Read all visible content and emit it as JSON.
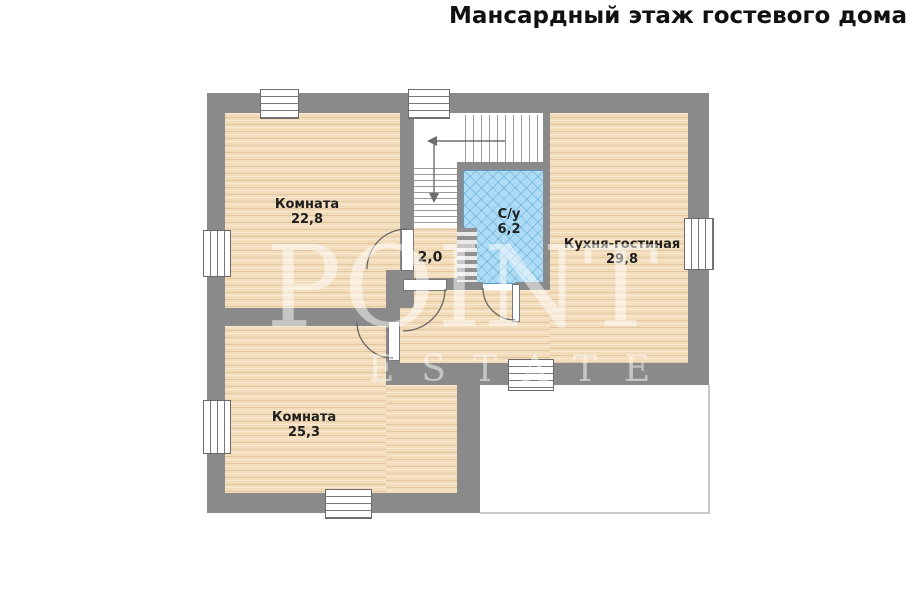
{
  "title": "Мансардный этаж гостевого дома",
  "watermark": {
    "line1": "POINT",
    "line2": "ESTATE"
  },
  "rooms": {
    "bedroom_top": {
      "name": "Комната",
      "area": "22,8"
    },
    "bedroom_bottom": {
      "name": "Комната",
      "area": "25,3"
    },
    "hall": {
      "area": "2,0"
    },
    "bathroom": {
      "name": "С/у",
      "area": "6,2"
    },
    "kitchen_living": {
      "name": "Кухня-гостиная",
      "area": "29,8"
    }
  },
  "colors": {
    "wall": "#8a8a8a",
    "wood_floor": "#f2dcba",
    "tile_floor": "#aedcf5",
    "cutout_outline": "#c8c8c8",
    "text": "#1e1e1e"
  }
}
